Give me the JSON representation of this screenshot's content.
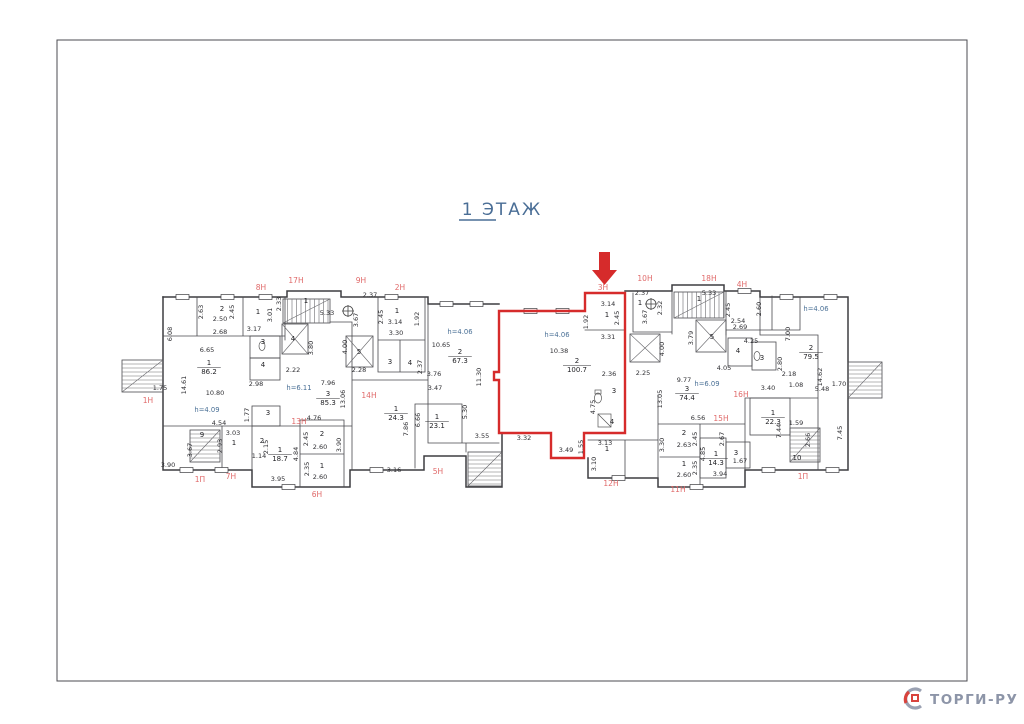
{
  "page": {
    "title": "1  ЭТАЖ"
  },
  "watermark": {
    "text": "ТОРГИ-РУ"
  },
  "colors": {
    "highlight": "#d62b2b",
    "unit_label": "#e06a6a",
    "height_note": "#4a7096",
    "wall": "#3d3d40",
    "title": "#4a6e96",
    "watermark_gray": "#9aa1b2",
    "watermark_red": "#d8433d"
  },
  "plan": {
    "highlighted_unit": "3Н",
    "labels": [
      {
        "t": "8Н",
        "x": 261,
        "y": 290,
        "c": "u"
      },
      {
        "t": "17Н",
        "x": 296,
        "y": 283,
        "c": "u"
      },
      {
        "t": "9Н",
        "x": 361,
        "y": 283,
        "c": "u"
      },
      {
        "t": "2Н",
        "x": 400,
        "y": 290,
        "c": "u"
      },
      {
        "t": "3Н",
        "x": 603,
        "y": 290,
        "c": "u"
      },
      {
        "t": "10Н",
        "x": 645,
        "y": 281,
        "c": "u"
      },
      {
        "t": "18Н",
        "x": 709,
        "y": 281,
        "c": "u"
      },
      {
        "t": "4Н",
        "x": 742,
        "y": 287,
        "c": "u"
      },
      {
        "t": "1Н",
        "x": 148,
        "y": 403,
        "c": "u"
      },
      {
        "t": "14Н",
        "x": 369,
        "y": 398,
        "c": "u"
      },
      {
        "t": "13Н",
        "x": 299,
        "y": 424,
        "c": "u"
      },
      {
        "t": "5Н",
        "x": 438,
        "y": 474,
        "c": "u"
      },
      {
        "t": "6Н",
        "x": 317,
        "y": 497,
        "c": "u"
      },
      {
        "t": "7Н",
        "x": 231,
        "y": 479,
        "c": "u"
      },
      {
        "t": "1П",
        "x": 200,
        "y": 482,
        "c": "u"
      },
      {
        "t": "15Н",
        "x": 721,
        "y": 421,
        "c": "u"
      },
      {
        "t": "16Н",
        "x": 741,
        "y": 397,
        "c": "u"
      },
      {
        "t": "12Н",
        "x": 611,
        "y": 486,
        "c": "u"
      },
      {
        "t": "11Н",
        "x": 678,
        "y": 492,
        "c": "u"
      },
      {
        "t": "1П",
        "x": 803,
        "y": 479,
        "c": "u"
      },
      {
        "t": "h=4.06",
        "x": 460,
        "y": 334,
        "c": "h"
      },
      {
        "t": "h=4.06",
        "x": 557,
        "y": 337,
        "c": "h"
      },
      {
        "t": "h=4.06",
        "x": 816,
        "y": 311,
        "c": "h"
      },
      {
        "t": "h=6.11",
        "x": 299,
        "y": 390,
        "c": "h"
      },
      {
        "t": "h=4.09",
        "x": 207,
        "y": 412,
        "c": "h"
      },
      {
        "t": "h=6.09",
        "x": 707,
        "y": 386,
        "c": "h"
      },
      {
        "t": "1",
        "x": 209,
        "y": 365,
        "c": "n"
      },
      {
        "t": "86.2",
        "x": 209,
        "y": 374,
        "c": "a"
      },
      {
        "t": "3",
        "x": 328,
        "y": 396,
        "c": "n"
      },
      {
        "t": "85.3",
        "x": 328,
        "y": 405,
        "c": "a"
      },
      {
        "t": "2",
        "x": 460,
        "y": 354,
        "c": "n"
      },
      {
        "t": "67.3",
        "x": 460,
        "y": 363,
        "c": "a"
      },
      {
        "t": "2",
        "x": 577,
        "y": 363,
        "c": "n"
      },
      {
        "t": "100.7",
        "x": 577,
        "y": 372,
        "c": "a"
      },
      {
        "t": "1",
        "x": 396,
        "y": 411,
        "c": "n"
      },
      {
        "t": "24.3",
        "x": 396,
        "y": 420,
        "c": "a"
      },
      {
        "t": "1",
        "x": 437,
        "y": 419,
        "c": "n"
      },
      {
        "t": "23.1",
        "x": 437,
        "y": 428,
        "c": "a"
      },
      {
        "t": "3",
        "x": 687,
        "y": 391,
        "c": "n"
      },
      {
        "t": "74.4",
        "x": 687,
        "y": 400,
        "c": "a"
      },
      {
        "t": "2",
        "x": 811,
        "y": 350,
        "c": "n"
      },
      {
        "t": "79.5",
        "x": 811,
        "y": 359,
        "c": "a"
      },
      {
        "t": "1",
        "x": 280,
        "y": 452,
        "c": "n"
      },
      {
        "t": "18.7",
        "x": 280,
        "y": 461,
        "c": "a"
      },
      {
        "t": "1",
        "x": 716,
        "y": 456,
        "c": "n"
      },
      {
        "t": "14.3",
        "x": 716,
        "y": 465,
        "c": "a"
      },
      {
        "t": "1",
        "x": 773,
        "y": 415,
        "c": "n"
      },
      {
        "t": "22.3",
        "x": 773,
        "y": 424,
        "c": "a"
      },
      {
        "t": "2",
        "x": 222,
        "y": 311,
        "c": "n"
      },
      {
        "t": "1",
        "x": 258,
        "y": 314,
        "c": "n"
      },
      {
        "t": "1",
        "x": 306,
        "y": 303,
        "c": "n"
      },
      {
        "t": "4",
        "x": 293,
        "y": 341,
        "c": "n"
      },
      {
        "t": "5",
        "x": 359,
        "y": 354,
        "c": "n"
      },
      {
        "t": "3",
        "x": 263,
        "y": 344,
        "c": "n"
      },
      {
        "t": "4",
        "x": 263,
        "y": 367,
        "c": "n"
      },
      {
        "t": "1",
        "x": 397,
        "y": 313,
        "c": "n"
      },
      {
        "t": "3",
        "x": 390,
        "y": 364,
        "c": "n"
      },
      {
        "t": "4",
        "x": 410,
        "y": 365,
        "c": "n"
      },
      {
        "t": "1",
        "x": 607,
        "y": 317,
        "c": "n"
      },
      {
        "t": "1",
        "x": 640,
        "y": 305,
        "c": "n"
      },
      {
        "t": "1",
        "x": 699,
        "y": 301,
        "c": "n"
      },
      {
        "t": "5",
        "x": 712,
        "y": 339,
        "c": "n"
      },
      {
        "t": "4",
        "x": 738,
        "y": 353,
        "c": "n"
      },
      {
        "t": "3",
        "x": 762,
        "y": 360,
        "c": "n"
      },
      {
        "t": "3",
        "x": 614,
        "y": 393,
        "c": "n"
      },
      {
        "t": "4",
        "x": 612,
        "y": 424,
        "c": "n"
      },
      {
        "t": "1",
        "x": 607,
        "y": 451,
        "c": "n"
      },
      {
        "t": "2",
        "x": 322,
        "y": 436,
        "c": "n"
      },
      {
        "t": "1",
        "x": 322,
        "y": 468,
        "c": "n"
      },
      {
        "t": "2",
        "x": 684,
        "y": 435,
        "c": "n"
      },
      {
        "t": "1",
        "x": 684,
        "y": 466,
        "c": "n"
      },
      {
        "t": "3",
        "x": 736,
        "y": 455,
        "c": "n"
      },
      {
        "t": "10",
        "x": 797,
        "y": 460,
        "c": "n"
      },
      {
        "t": "9",
        "x": 202,
        "y": 437,
        "c": "n"
      },
      {
        "t": "1",
        "x": 234,
        "y": 445,
        "c": "n"
      },
      {
        "t": "2",
        "x": 262,
        "y": 443,
        "c": "n"
      },
      {
        "t": "3",
        "x": 268,
        "y": 415,
        "c": "n"
      },
      {
        "t": "1.75",
        "x": 160,
        "y": 390,
        "c": "d"
      },
      {
        "t": "6.08",
        "x": 172,
        "y": 334,
        "c": "d",
        "r": 1
      },
      {
        "t": "14.61",
        "x": 186,
        "y": 385,
        "c": "d",
        "r": 1
      },
      {
        "t": "2.63",
        "x": 203,
        "y": 312,
        "c": "d",
        "r": 1
      },
      {
        "t": "2.50",
        "x": 220,
        "y": 321,
        "c": "d"
      },
      {
        "t": "2.45",
        "x": 234,
        "y": 312,
        "c": "d",
        "r": 1
      },
      {
        "t": "2.68",
        "x": 220,
        "y": 334,
        "c": "d"
      },
      {
        "t": "3.17",
        "x": 254,
        "y": 331,
        "c": "d"
      },
      {
        "t": "3.01",
        "x": 272,
        "y": 315,
        "c": "d",
        "r": 1
      },
      {
        "t": "2.33",
        "x": 281,
        "y": 304,
        "c": "d",
        "r": 1
      },
      {
        "t": "5.33",
        "x": 327,
        "y": 315,
        "c": "d"
      },
      {
        "t": "2.37",
        "x": 370,
        "y": 297,
        "c": "d"
      },
      {
        "t": "3.67",
        "x": 358,
        "y": 320,
        "c": "d",
        "r": 1
      },
      {
        "t": "2.45",
        "x": 383,
        "y": 317,
        "c": "d",
        "r": 1
      },
      {
        "t": "3.14",
        "x": 395,
        "y": 324,
        "c": "d"
      },
      {
        "t": "1.92",
        "x": 419,
        "y": 319,
        "c": "d",
        "r": 1
      },
      {
        "t": "3.30",
        "x": 396,
        "y": 335,
        "c": "d"
      },
      {
        "t": "6.65",
        "x": 207,
        "y": 352,
        "c": "d"
      },
      {
        "t": "10.80",
        "x": 215,
        "y": 395,
        "c": "d"
      },
      {
        "t": "2.98",
        "x": 256,
        "y": 386,
        "c": "d"
      },
      {
        "t": "2.22",
        "x": 293,
        "y": 372,
        "c": "d"
      },
      {
        "t": "2.28",
        "x": 359,
        "y": 372,
        "c": "d"
      },
      {
        "t": "3.80",
        "x": 313,
        "y": 348,
        "c": "d",
        "r": 1
      },
      {
        "t": "4.00",
        "x": 347,
        "y": 347,
        "c": "d",
        "r": 1
      },
      {
        "t": "7.96",
        "x": 328,
        "y": 385,
        "c": "d"
      },
      {
        "t": "13.06",
        "x": 345,
        "y": 399,
        "c": "d",
        "r": 1
      },
      {
        "t": "4.54",
        "x": 219,
        "y": 425,
        "c": "d"
      },
      {
        "t": "1.77",
        "x": 249,
        "y": 415,
        "c": "d",
        "r": 1
      },
      {
        "t": "3.03",
        "x": 233,
        "y": 435,
        "c": "d"
      },
      {
        "t": "2.93",
        "x": 222,
        "y": 446,
        "c": "d",
        "r": 1
      },
      {
        "t": "3.67",
        "x": 192,
        "y": 450,
        "c": "d",
        "r": 1
      },
      {
        "t": "2.15",
        "x": 268,
        "y": 447,
        "c": "d",
        "r": 1
      },
      {
        "t": "1.14",
        "x": 259,
        "y": 458,
        "c": "d"
      },
      {
        "t": "3.90",
        "x": 168,
        "y": 467,
        "c": "d"
      },
      {
        "t": "3.95",
        "x": 278,
        "y": 481,
        "c": "d"
      },
      {
        "t": "4.84",
        "x": 298,
        "y": 454,
        "c": "d",
        "r": 1
      },
      {
        "t": "4.76",
        "x": 314,
        "y": 420,
        "c": "d"
      },
      {
        "t": "2.45",
        "x": 308,
        "y": 439,
        "c": "d",
        "r": 1
      },
      {
        "t": "2.60",
        "x": 320,
        "y": 449,
        "c": "d"
      },
      {
        "t": "2.35",
        "x": 309,
        "y": 469,
        "c": "d",
        "r": 1
      },
      {
        "t": "2.60",
        "x": 320,
        "y": 479,
        "c": "d"
      },
      {
        "t": "3.90",
        "x": 341,
        "y": 445,
        "c": "d",
        "r": 1
      },
      {
        "t": "3.16",
        "x": 394,
        "y": 472,
        "c": "d"
      },
      {
        "t": "7.86",
        "x": 408,
        "y": 429,
        "c": "d",
        "r": 1
      },
      {
        "t": "6.66",
        "x": 420,
        "y": 420,
        "c": "d",
        "r": 1
      },
      {
        "t": "5.30",
        "x": 467,
        "y": 412,
        "c": "d",
        "r": 1
      },
      {
        "t": "3.55",
        "x": 482,
        "y": 438,
        "c": "d"
      },
      {
        "t": "2.37",
        "x": 422,
        "y": 367,
        "c": "d",
        "r": 1
      },
      {
        "t": "3.76",
        "x": 434,
        "y": 376,
        "c": "d"
      },
      {
        "t": "3.47",
        "x": 435,
        "y": 390,
        "c": "d"
      },
      {
        "t": "10.65",
        "x": 441,
        "y": 347,
        "c": "d"
      },
      {
        "t": "11.30",
        "x": 481,
        "y": 377,
        "c": "d",
        "r": 1
      },
      {
        "t": "3.32",
        "x": 524,
        "y": 440,
        "c": "d"
      },
      {
        "t": "3.49",
        "x": 566,
        "y": 452,
        "c": "d"
      },
      {
        "t": "1.55",
        "x": 583,
        "y": 447,
        "c": "d",
        "r": 1
      },
      {
        "t": "10.38",
        "x": 559,
        "y": 353,
        "c": "d"
      },
      {
        "t": "3.14",
        "x": 608,
        "y": 306,
        "c": "d"
      },
      {
        "t": "1.92",
        "x": 588,
        "y": 322,
        "c": "d",
        "r": 1
      },
      {
        "t": "2.45",
        "x": 619,
        "y": 318,
        "c": "d",
        "r": 1
      },
      {
        "t": "3.31",
        "x": 608,
        "y": 339,
        "c": "d"
      },
      {
        "t": "2.36",
        "x": 609,
        "y": 376,
        "c": "d"
      },
      {
        "t": "2.25",
        "x": 643,
        "y": 375,
        "c": "d"
      },
      {
        "t": "4.75",
        "x": 595,
        "y": 407,
        "c": "d",
        "r": 1
      },
      {
        "t": "3.13",
        "x": 605,
        "y": 445,
        "c": "d"
      },
      {
        "t": "3.10",
        "x": 596,
        "y": 464,
        "c": "d",
        "r": 1
      },
      {
        "t": "2.37",
        "x": 642,
        "y": 295,
        "c": "d"
      },
      {
        "t": "3.67",
        "x": 647,
        "y": 317,
        "c": "d",
        "r": 1
      },
      {
        "t": "2.32",
        "x": 662,
        "y": 308,
        "c": "d",
        "r": 1
      },
      {
        "t": "4.00",
        "x": 664,
        "y": 349,
        "c": "d",
        "r": 1
      },
      {
        "t": "5.33",
        "x": 709,
        "y": 295,
        "c": "d"
      },
      {
        "t": "3.79",
        "x": 693,
        "y": 338,
        "c": "d",
        "r": 1
      },
      {
        "t": "2.45",
        "x": 730,
        "y": 310,
        "c": "d",
        "r": 1
      },
      {
        "t": "2.60",
        "x": 761,
        "y": 309,
        "c": "d",
        "r": 1
      },
      {
        "t": "2.54",
        "x": 738,
        "y": 323,
        "c": "d"
      },
      {
        "t": "2.69",
        "x": 740,
        "y": 329,
        "c": "d"
      },
      {
        "t": "4.25",
        "x": 751,
        "y": 343,
        "c": "d"
      },
      {
        "t": "4.05",
        "x": 724,
        "y": 370,
        "c": "d"
      },
      {
        "t": "9.77",
        "x": 684,
        "y": 382,
        "c": "d"
      },
      {
        "t": "13.05",
        "x": 662,
        "y": 399,
        "c": "d",
        "r": 1
      },
      {
        "t": "6.56",
        "x": 698,
        "y": 420,
        "c": "d"
      },
      {
        "t": "2.45",
        "x": 697,
        "y": 439,
        "c": "d",
        "r": 1
      },
      {
        "t": "2.63",
        "x": 684,
        "y": 447,
        "c": "d"
      },
      {
        "t": "3.30",
        "x": 664,
        "y": 445,
        "c": "d",
        "r": 1
      },
      {
        "t": "2.35",
        "x": 697,
        "y": 468,
        "c": "d",
        "r": 1
      },
      {
        "t": "2.60",
        "x": 684,
        "y": 477,
        "c": "d"
      },
      {
        "t": "4.85",
        "x": 705,
        "y": 454,
        "c": "d",
        "r": 1
      },
      {
        "t": "2.67",
        "x": 724,
        "y": 439,
        "c": "d",
        "r": 1
      },
      {
        "t": "1.67",
        "x": 740,
        "y": 463,
        "c": "d"
      },
      {
        "t": "3.94",
        "x": 720,
        "y": 476,
        "c": "d"
      },
      {
        "t": "7.00",
        "x": 790,
        "y": 334,
        "c": "d",
        "r": 1
      },
      {
        "t": "2.80",
        "x": 782,
        "y": 364,
        "c": "d",
        "r": 1
      },
      {
        "t": "2.18",
        "x": 789,
        "y": 376,
        "c": "d"
      },
      {
        "t": "1.08",
        "x": 796,
        "y": 387,
        "c": "d"
      },
      {
        "t": "3.40",
        "x": 768,
        "y": 390,
        "c": "d"
      },
      {
        "t": "14.62",
        "x": 822,
        "y": 377,
        "c": "d",
        "r": 1
      },
      {
        "t": "5.48",
        "x": 822,
        "y": 391,
        "c": "d"
      },
      {
        "t": "1.70",
        "x": 839,
        "y": 386,
        "c": "d"
      },
      {
        "t": "7.44",
        "x": 781,
        "y": 431,
        "c": "d",
        "r": 1
      },
      {
        "t": "1.59",
        "x": 796,
        "y": 425,
        "c": "d"
      },
      {
        "t": "2.66",
        "x": 810,
        "y": 440,
        "c": "d",
        "r": 1
      },
      {
        "t": "7.45",
        "x": 842,
        "y": 433,
        "c": "d",
        "r": 1
      }
    ]
  }
}
